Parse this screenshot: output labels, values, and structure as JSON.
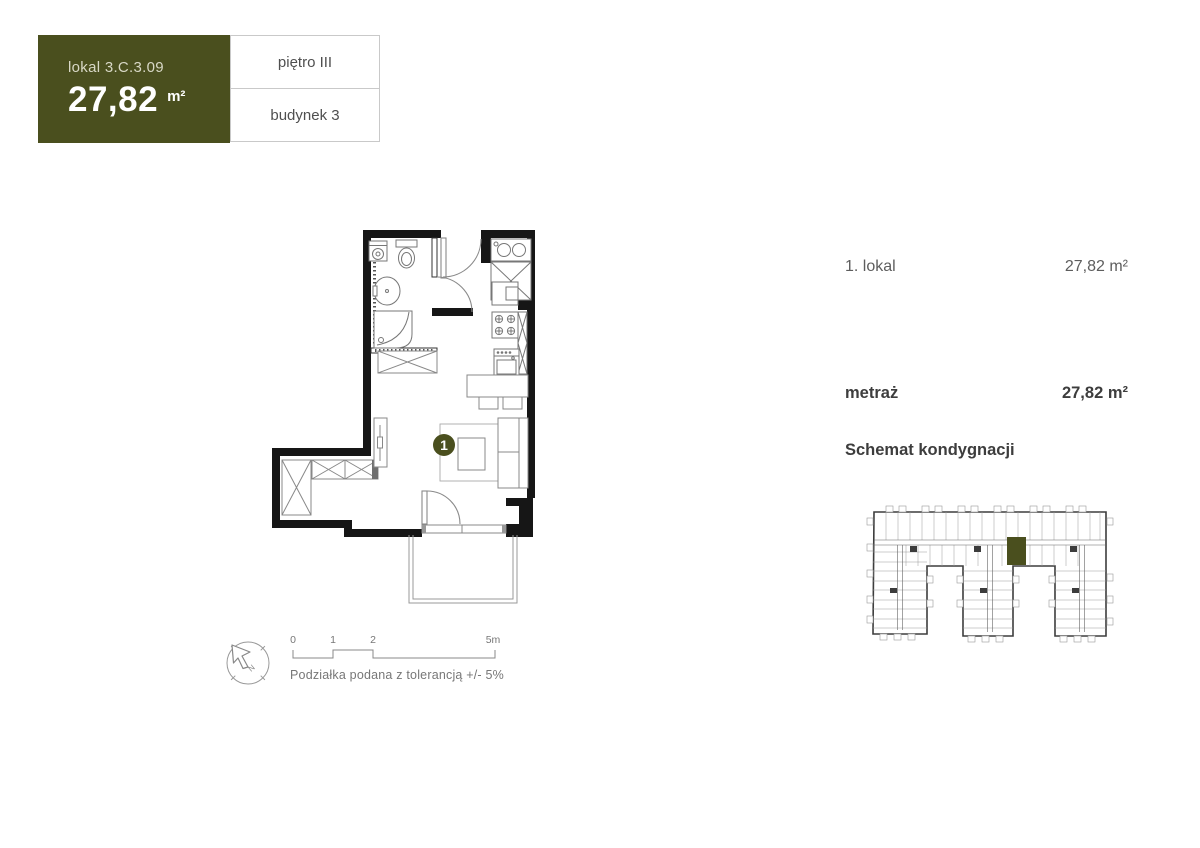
{
  "unit_card": {
    "lokal_label": "lokal 3.C.3.09",
    "area_value": "27,82",
    "area_unit": "m²",
    "floor": "piętro III",
    "building": "budynek 3"
  },
  "details": {
    "row_label": "1. lokal",
    "row_value": "27,82 m²",
    "metraz_label": "metraż",
    "metraz_value": "27,82 m²",
    "schemat_label": "Schemat kondygnacji"
  },
  "floorplan": {
    "unit_marker": "1"
  },
  "scalebar": {
    "ticks": [
      "0",
      "1",
      "2",
      "5m"
    ],
    "note": "Podziałka podana z tolerancją +/- 5%"
  },
  "compass": {
    "label": "N"
  },
  "colors": {
    "accent_olive": "#4a4f1e",
    "wall_black": "#161616",
    "furniture_gray": "#8a8a8a",
    "border_gray": "#c9c9c9",
    "text_dark": "#3d3d3d",
    "text_gray": "#5d5d5d"
  }
}
